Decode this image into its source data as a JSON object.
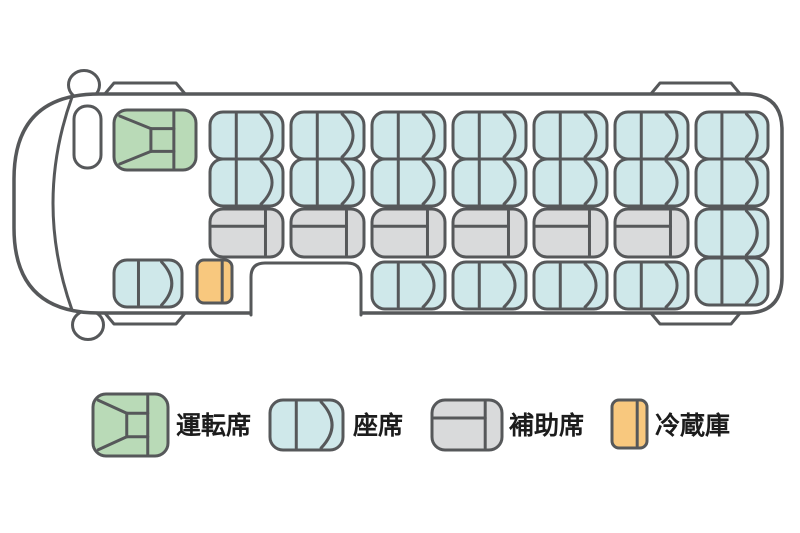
{
  "colors": {
    "stroke": "#56585a",
    "driver": "#b9dab7",
    "seat": "#cfe8ea",
    "aux": "#d9dadb",
    "fridge": "#f8c87e",
    "background": "#ffffff",
    "text": "#1c1c1c"
  },
  "names": {
    "driver": "driver-seat",
    "seat": "passenger-seat",
    "aux": "auxiliary-seat",
    "fridge": "refrigerator"
  },
  "legend": {
    "items": [
      {
        "type": "driver",
        "label": "運転席",
        "icon": [
          93,
          394,
          75,
          62
        ]
      },
      {
        "type": "seat",
        "label": "座席",
        "icon": [
          270,
          400,
          73,
          50
        ]
      },
      {
        "type": "aux",
        "label": "補助席",
        "icon": [
          432,
          400,
          70,
          50
        ]
      },
      {
        "type": "fridge",
        "label": "冷蔵庫",
        "icon": [
          612,
          400,
          35,
          48
        ]
      }
    ]
  },
  "counts": {
    "driver_seats": 1,
    "passenger_seats": 21,
    "auxiliary_seats": 6,
    "refrigerators": 1
  },
  "seat_map": {
    "driver": [
      [
        114,
        110,
        82,
        60
      ]
    ],
    "seat": [
      [
        210,
        112,
        73,
        47
      ],
      [
        291,
        112,
        73,
        47
      ],
      [
        372,
        112,
        73,
        47
      ],
      [
        453,
        112,
        73,
        47
      ],
      [
        534,
        112,
        73,
        47
      ],
      [
        615,
        112,
        73,
        47
      ],
      [
        210,
        159,
        73,
        47
      ],
      [
        291,
        159,
        73,
        47
      ],
      [
        372,
        159,
        73,
        47
      ],
      [
        453,
        159,
        73,
        47
      ],
      [
        534,
        159,
        73,
        47
      ],
      [
        615,
        159,
        73,
        47
      ],
      [
        696,
        112,
        72,
        47
      ],
      [
        696,
        159,
        72,
        47
      ],
      [
        696,
        209,
        72,
        48
      ],
      [
        696,
        258,
        72,
        47
      ],
      [
        372,
        262,
        73,
        47
      ],
      [
        453,
        262,
        73,
        47
      ],
      [
        534,
        262,
        73,
        47
      ],
      [
        615,
        262,
        73,
        47
      ],
      [
        114,
        260,
        68,
        47
      ]
    ],
    "aux": [
      [
        210,
        209,
        73,
        48
      ],
      [
        291,
        209,
        73,
        48
      ],
      [
        372,
        209,
        73,
        48
      ],
      [
        453,
        209,
        73,
        48
      ],
      [
        534,
        209,
        73,
        48
      ],
      [
        615,
        209,
        73,
        48
      ]
    ],
    "fridge": [
      [
        197,
        260,
        35,
        43
      ]
    ]
  }
}
